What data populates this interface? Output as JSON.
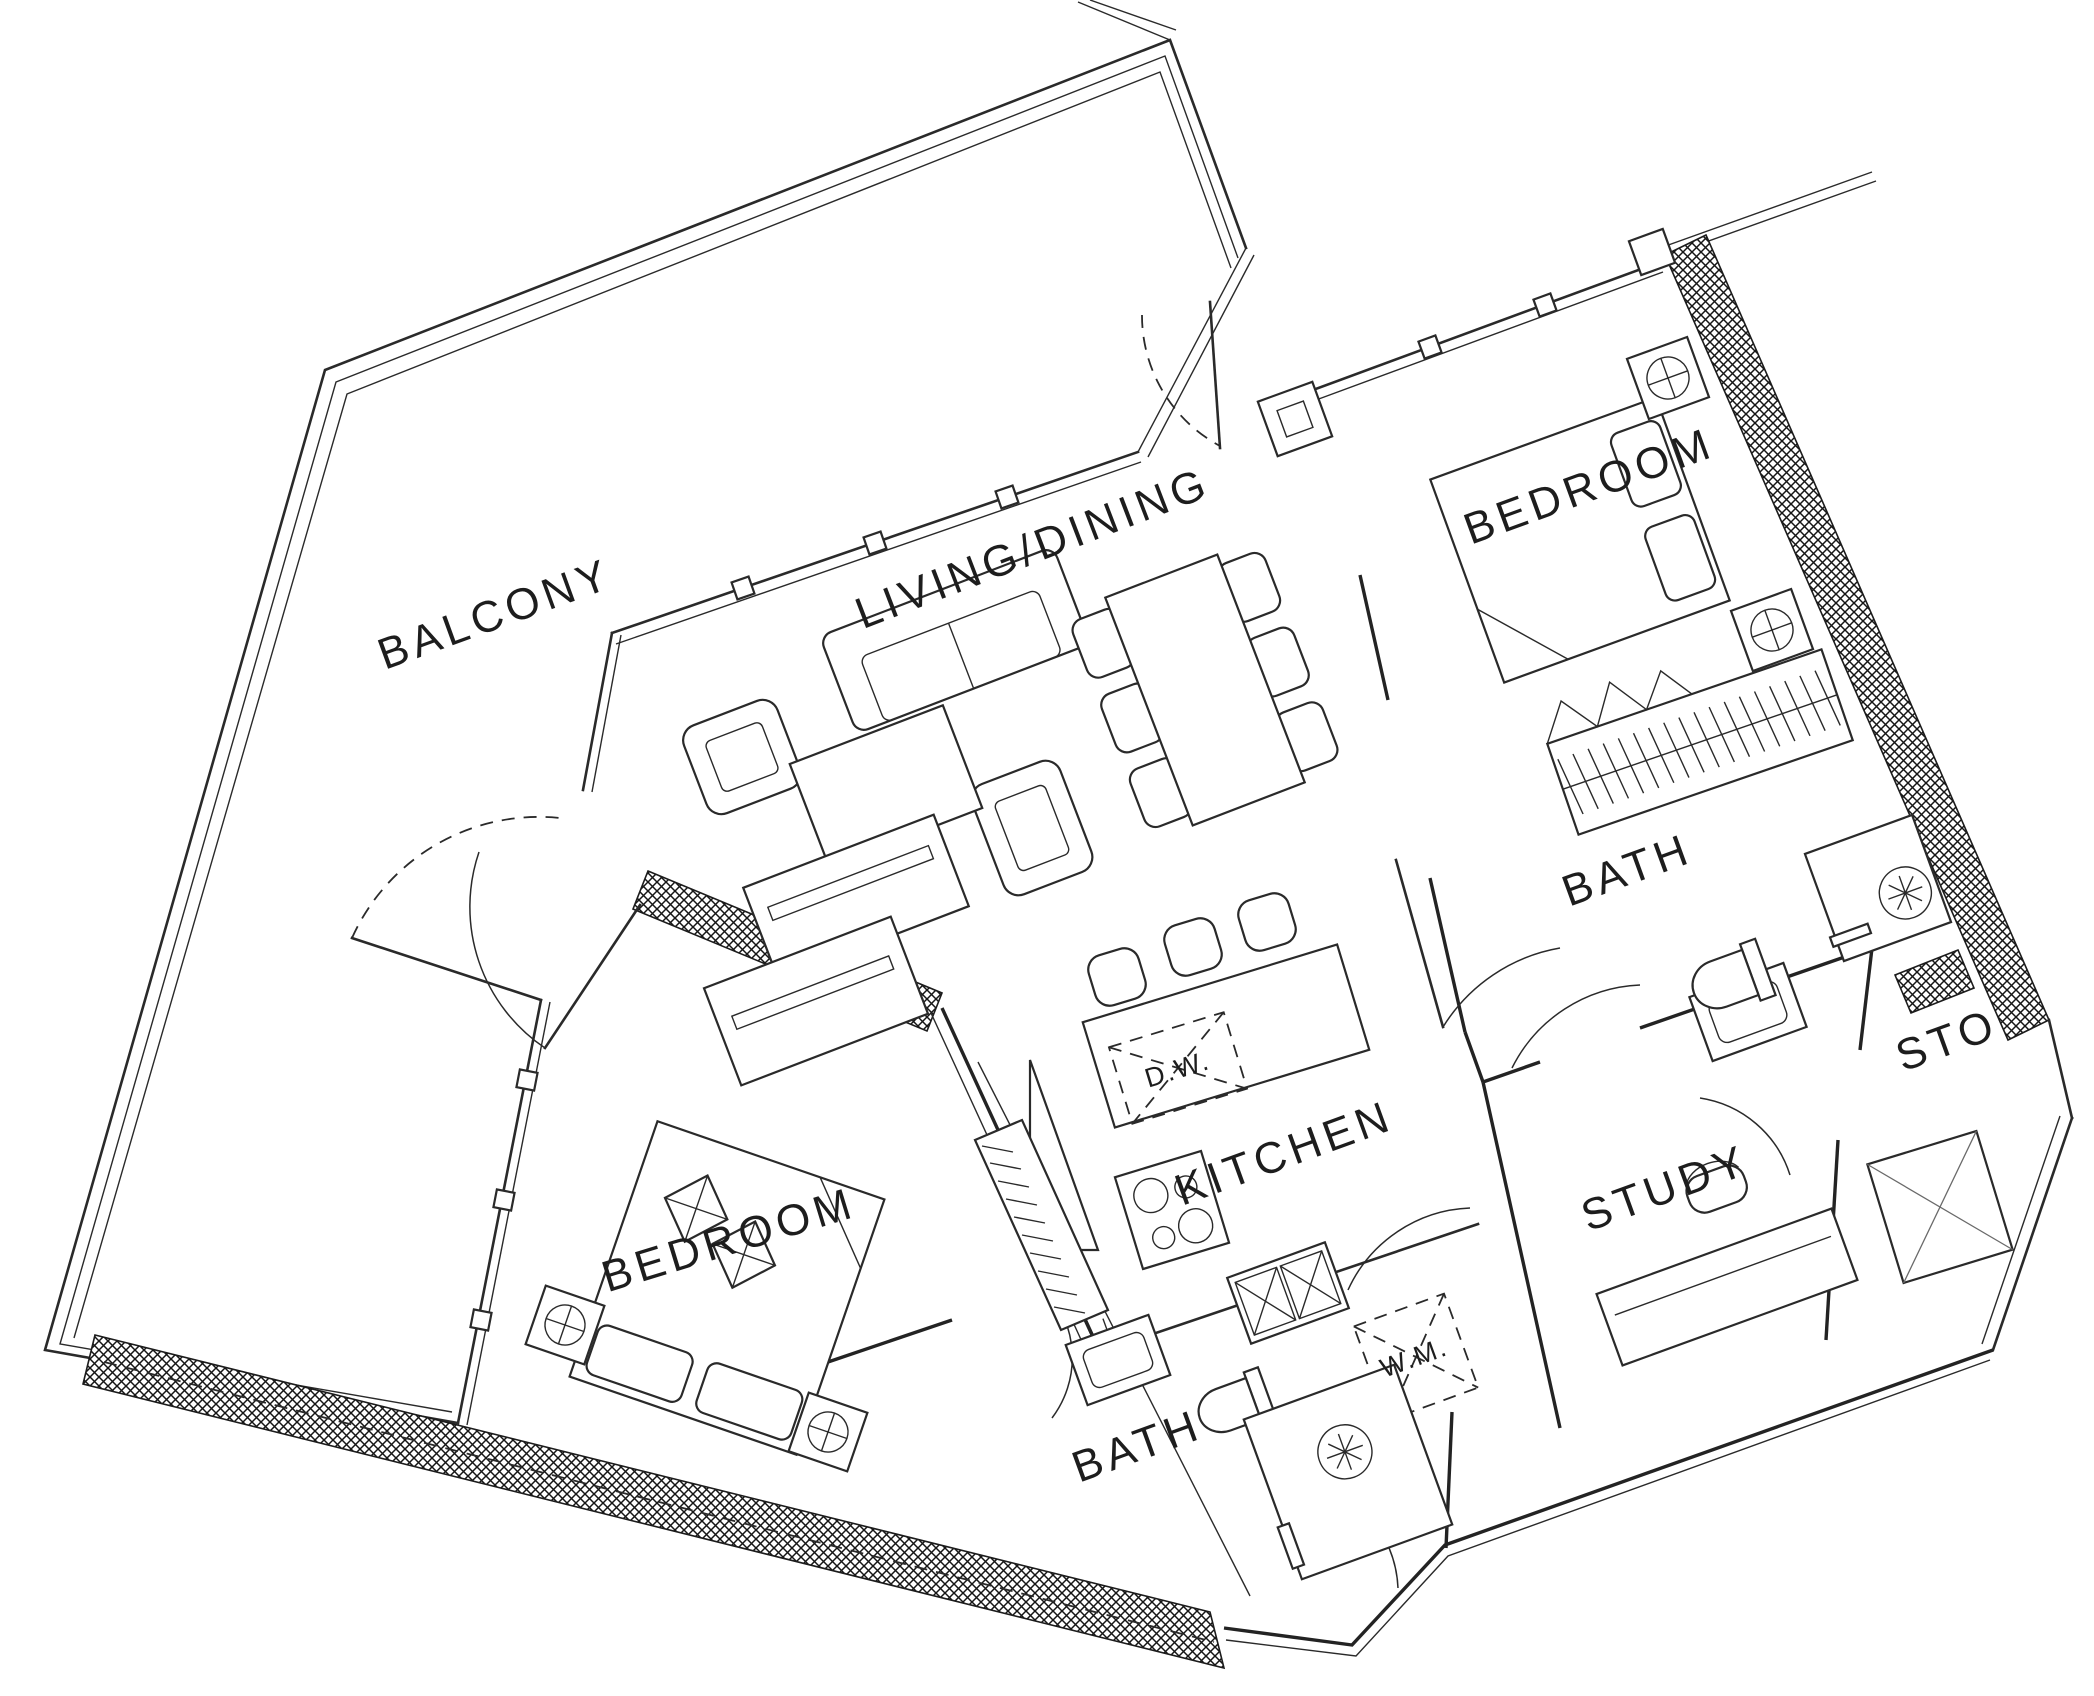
{
  "drawing": {
    "type": "architectural-floor-plan",
    "colors": {
      "background": "#ffffff",
      "line": "#2a2a2a",
      "hatch": "#161616"
    },
    "rooms": [
      {
        "id": "balcony",
        "label": "BALCONY"
      },
      {
        "id": "living-dining",
        "label": "LIVING/DINING"
      },
      {
        "id": "bedroom-master",
        "label": "BEDROOM"
      },
      {
        "id": "bath-master",
        "label": "BATH"
      },
      {
        "id": "storage",
        "label": "STO"
      },
      {
        "id": "study",
        "label": "STUDY"
      },
      {
        "id": "kitchen",
        "label": "KITCHEN"
      },
      {
        "id": "bedroom-second",
        "label": "BEDROOM"
      },
      {
        "id": "bath-second",
        "label": "BATH"
      }
    ],
    "appliances": [
      {
        "id": "dishwasher",
        "label": "D.W."
      },
      {
        "id": "washing-machine",
        "label": "W.M."
      }
    ]
  }
}
